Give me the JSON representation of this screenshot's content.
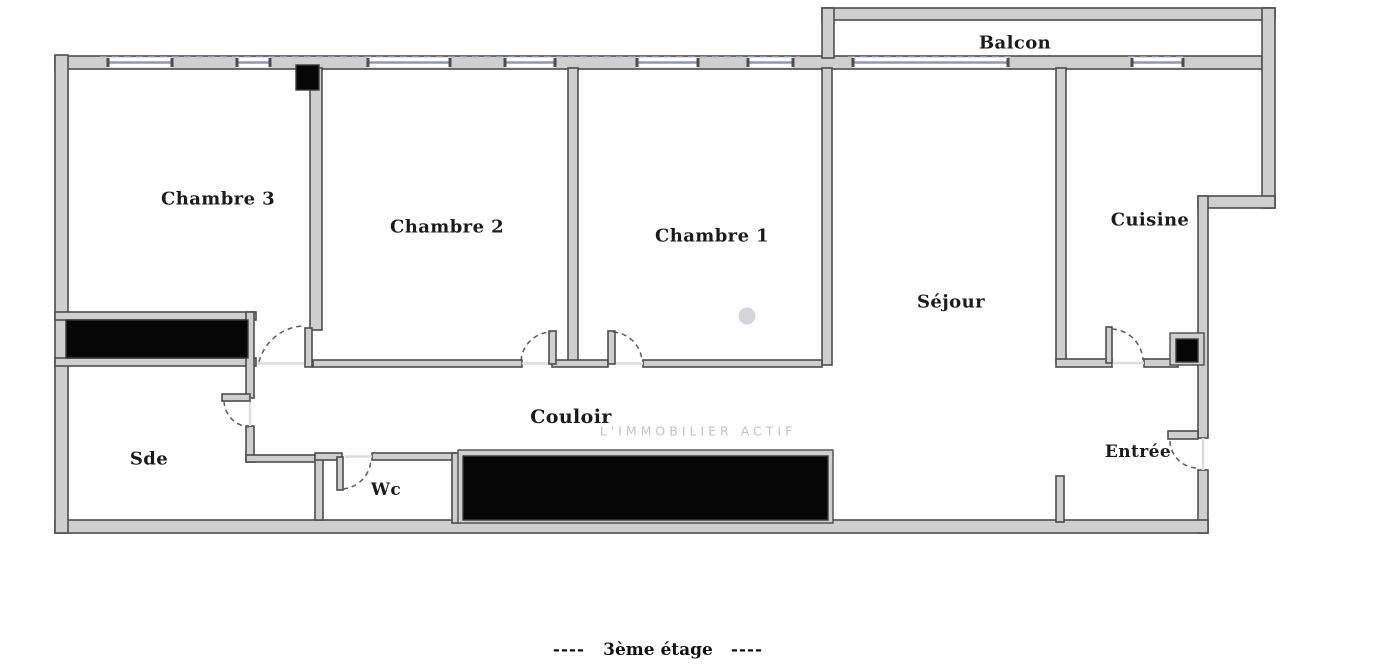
{
  "plan": {
    "rooms": {
      "balcon": "Balcon",
      "chambre3": "Chambre 3",
      "chambre2": "Chambre 2",
      "chambre1": "Chambre 1",
      "sejour": "Séjour",
      "cuisine": "Cuisine",
      "sde": "Sde",
      "couloir": "Couloir",
      "wc": "Wc",
      "entree": "Entrée"
    },
    "caption": {
      "dashes_left": "----",
      "text": "3ème étage",
      "dashes_right": "----"
    },
    "watermark": "L'IMMOBILIER ACTIF",
    "colors": {
      "wall_fill": "#cfcfcf",
      "wall_stroke": "#4d4d4d",
      "window_blue": "#8e95c4",
      "void_black": "#060606",
      "label_color": "#1b1b1b",
      "watermark_gray": "#c2c2c2",
      "background": "#ffffff"
    }
  }
}
